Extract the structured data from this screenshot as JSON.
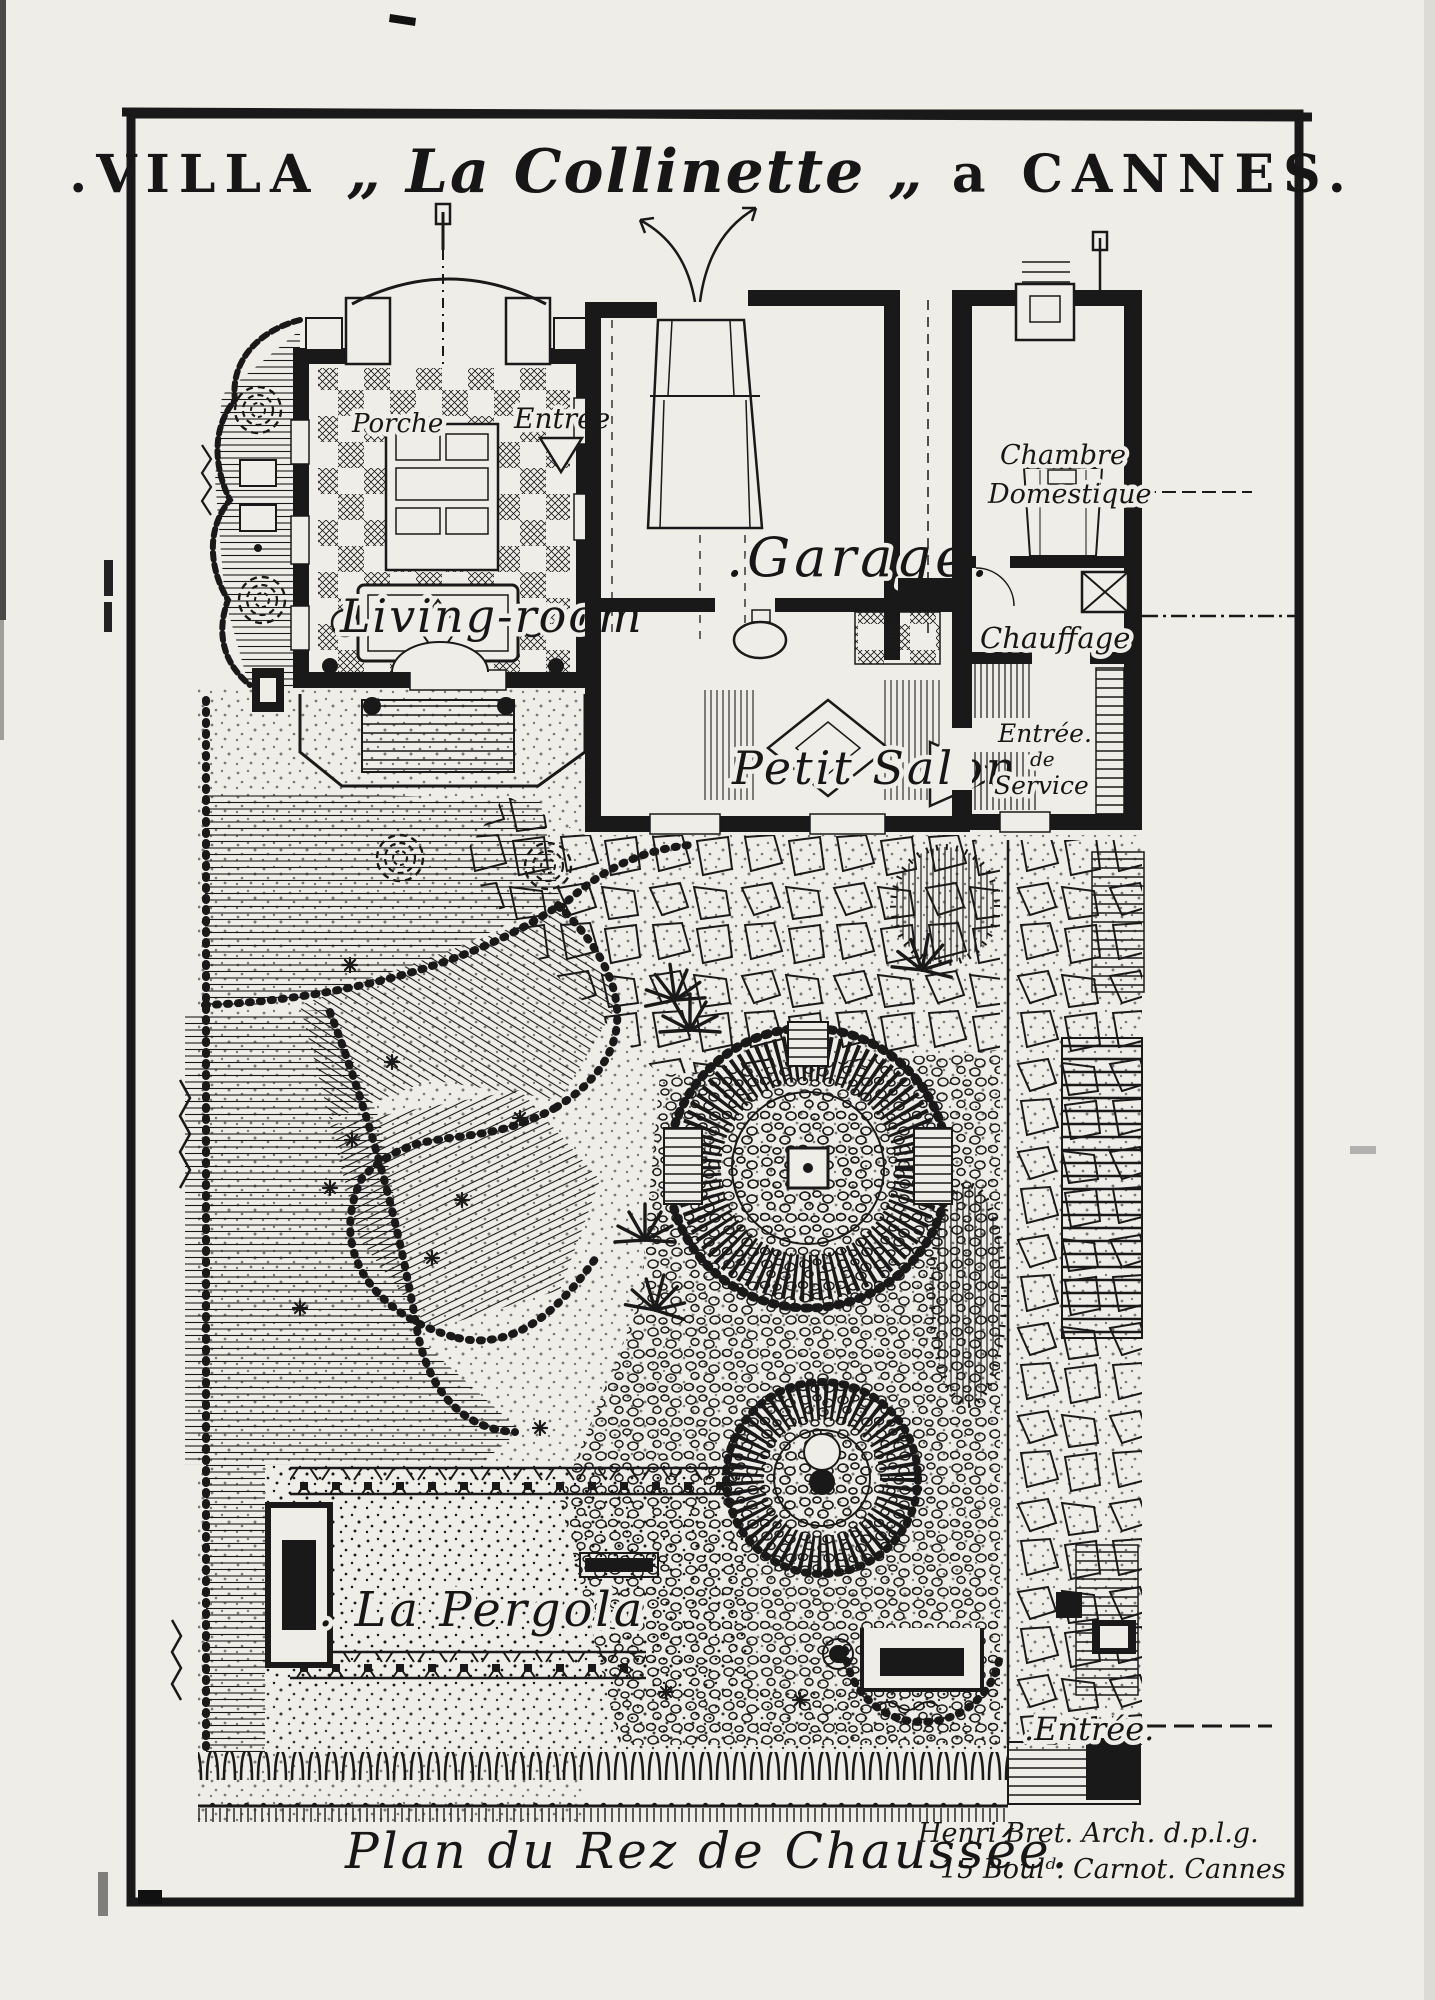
{
  "colors": {
    "ink": "#191919",
    "paper": "#efede8"
  },
  "title": {
    "part1": ".VILLA",
    "part2": "„ La Collinette „",
    "part3": "a CANNES."
  },
  "labels": {
    "porche": "Porche",
    "entree_hall": "Entrée",
    "living_room": "Living-room",
    "garage": ".Garage.",
    "petit_salon": "Petit Salon",
    "chambre_line1": "Chambre",
    "chambre_line2": "Domestique",
    "chauffage": "Chauffage",
    "service_line1": "Entrée.",
    "service_line2": "de",
    "service_line3": "Service",
    "pergola": ". La Pergola",
    "garden_entree": ".Entrée."
  },
  "caption": {
    "plan": "Plan du Rez de Chaussée."
  },
  "credit": {
    "line1": "Henri Bret. Arch. d.p.l.g.",
    "line2": "15 Boulᵈ. Carnot. Cannes"
  }
}
